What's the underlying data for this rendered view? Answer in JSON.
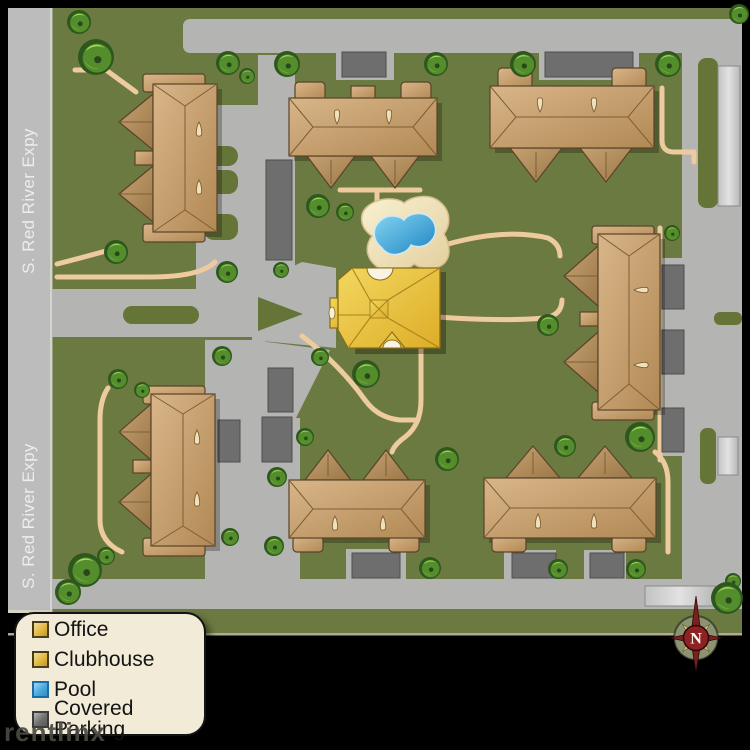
{
  "street": {
    "labels": [
      "S. Red River Expy",
      "S. Red River Expy"
    ]
  },
  "legend": {
    "items": [
      {
        "label": "Office",
        "color": "#e5b93e"
      },
      {
        "label": "Clubhouse",
        "color": "#e5b93e"
      },
      {
        "label": "Pool",
        "color": "#45aade"
      },
      {
        "label": "Covered Parking",
        "color": "#6e6e6e"
      }
    ]
  },
  "compass": {
    "north_label": "N"
  },
  "watermark": {
    "text": "rentlinx"
  },
  "colors": {
    "grass": "#6b7a41",
    "grass_island": "#657538",
    "road": "#b4b4b2",
    "highway": "#bcbcbc",
    "walk_path": "#eecb9f",
    "building_tan": "#c8a26d",
    "office_gold": "#eac33e",
    "pool_water": "#3ea2d8",
    "pool_deck": "#f2e7c2",
    "covered_parking": "#6e6e6e",
    "legend_bg": "#f1ebd7",
    "compass_red": "#7e1f1f",
    "compass_khaki": "#d9c387"
  }
}
